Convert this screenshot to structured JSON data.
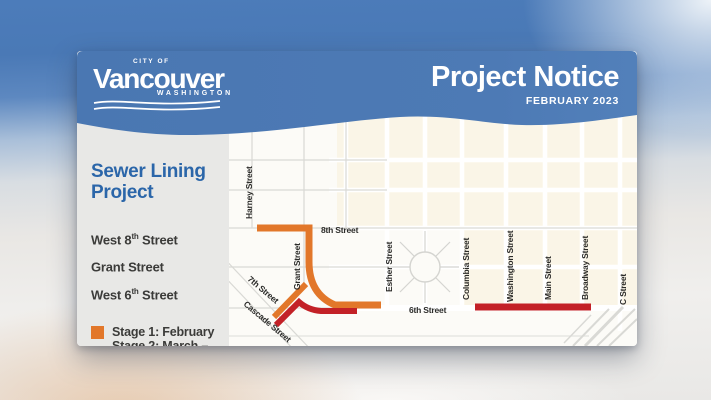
{
  "header": {
    "logo": {
      "city_of": "CITY OF",
      "name": "Vancouver",
      "state": "WASHINGTON"
    },
    "title": "Project Notice",
    "date": "FEBRUARY 2023",
    "band_color": "#4a77b2"
  },
  "panel": {
    "heading_line1": "Sewer Lining",
    "heading_line2": "Project",
    "streets": [
      {
        "main": "West 8",
        "sup": "th",
        "rest": " Street"
      },
      {
        "main": "Grant",
        "sup": "",
        "rest": " Street"
      },
      {
        "main": "West 6",
        "sup": "th",
        "rest": " Street"
      }
    ]
  },
  "legend": [
    {
      "color": "#e2772a",
      "label": "Stage 1: February"
    },
    {
      "color": "#c32127",
      "label": "Stage 2: March – April"
    }
  ],
  "map": {
    "labels": {
      "harney": "Harney Street",
      "grant": "Grant Street",
      "eighth": "8th Street",
      "seventh": "7th Street",
      "cascade": "Cascade Street",
      "esther": "Esther Street",
      "sixth": "6th Street",
      "columbia": "Columbia Street",
      "washington": "Washington Street",
      "main": "Main Street",
      "broadway": "Broadway Street",
      "c": "C Street"
    },
    "route_colors": {
      "stage1": "#e2772a",
      "stage2": "#c32127"
    },
    "block_color": "#faf5e7"
  }
}
